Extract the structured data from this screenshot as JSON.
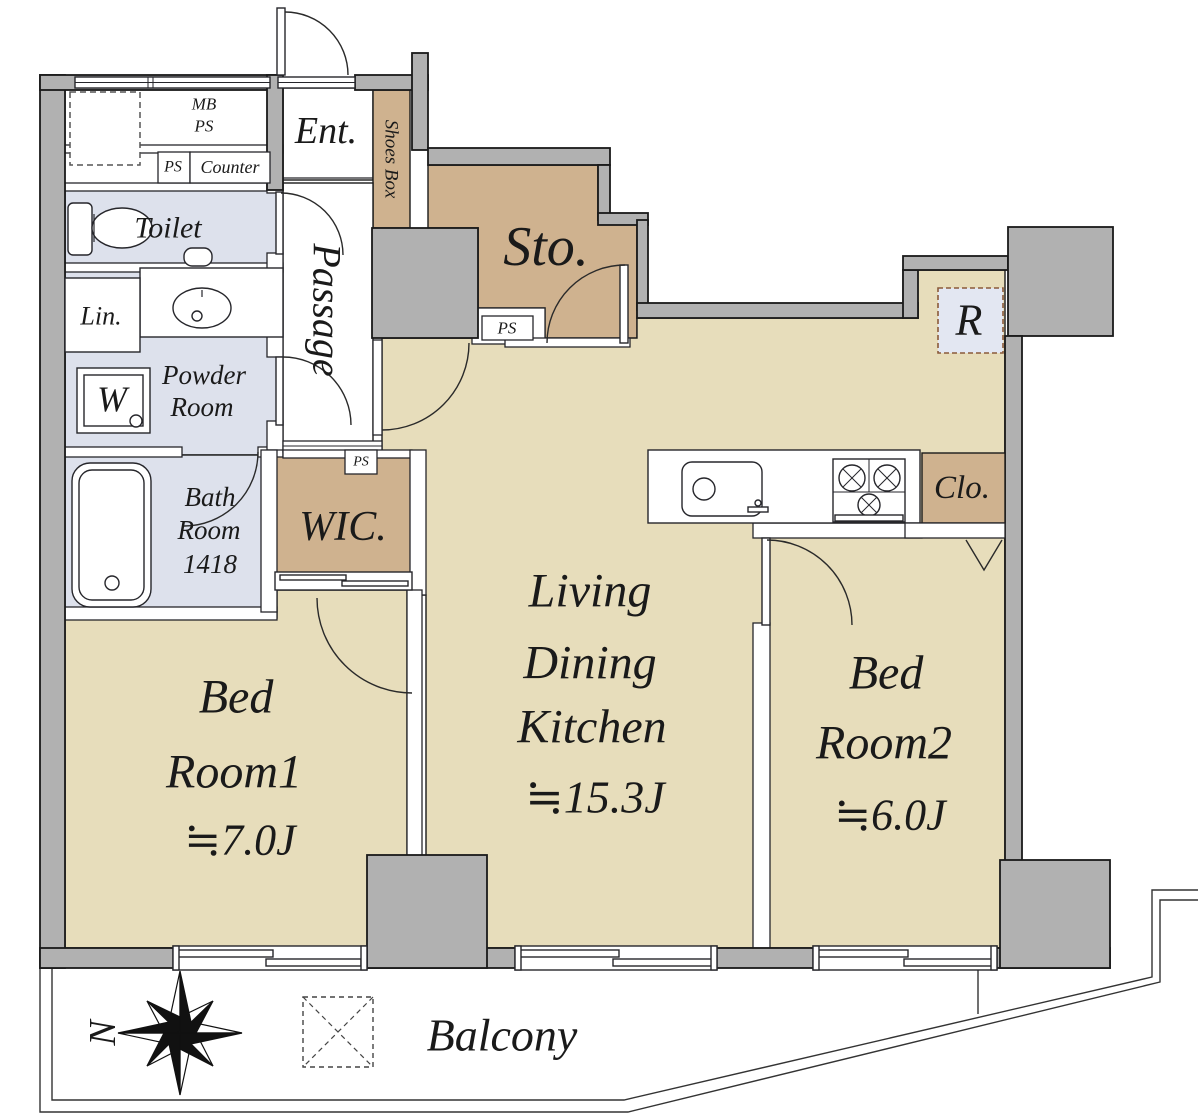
{
  "plan_type": "floor-plan",
  "colors": {
    "floor": "#e7ddbb",
    "closet_floor": "#cfb28f",
    "wet_area_floor": "#dde1ec",
    "wall": "#b1b1b1",
    "size_red": "#c4251f"
  },
  "rooms": {
    "entrance": {
      "label": "Ent."
    },
    "shoes_box": {
      "label": "Shoes Box"
    },
    "passage": {
      "label": "Passage"
    },
    "storage": {
      "label": "Sto."
    },
    "toilet": {
      "label": "Toilet"
    },
    "linen": {
      "label": "Lin."
    },
    "powder_room": {
      "line1": "Powder",
      "line2": "Room"
    },
    "bath_room": {
      "line1": "Bath",
      "line2": "Room",
      "size": "1418"
    },
    "wic": {
      "label": "WIC."
    },
    "ldk": {
      "line1": "Living",
      "line2": "Dining",
      "line3": "Kitchen",
      "size": "≒15.3J"
    },
    "bedroom1": {
      "line1": "Bed",
      "line2": "Room1",
      "size": "≒7.0J"
    },
    "bedroom2": {
      "line1": "Bed",
      "line2": "Room2",
      "size": "≒6.0J"
    },
    "closet": {
      "label": "Clo."
    },
    "balcony": {
      "label": "Balcony"
    }
  },
  "fixtures": {
    "meter_box_line1": "MB",
    "meter_box_line2": "PS",
    "pipe_space_toilet": "PS",
    "pipe_space_storage": "PS",
    "pipe_space_wic": "PS",
    "counter": "Counter",
    "washing_machine": "W",
    "refrigerator": "R"
  },
  "compass": {
    "north": "N"
  }
}
